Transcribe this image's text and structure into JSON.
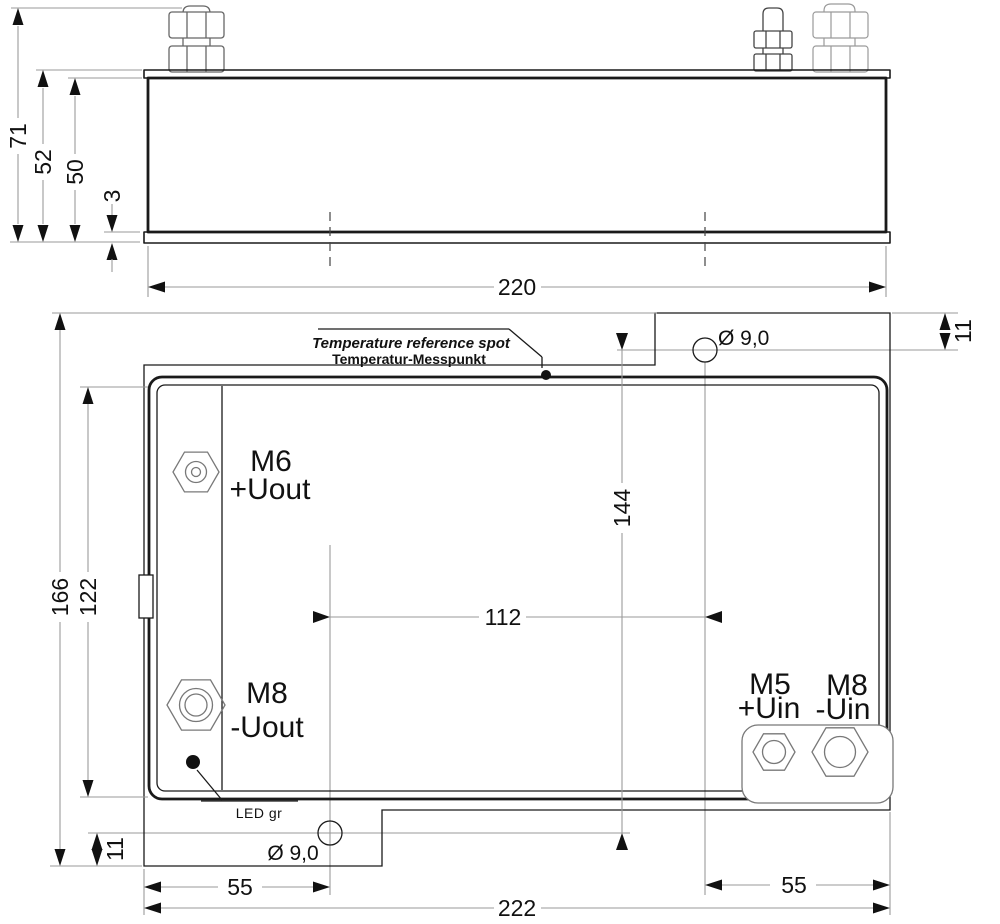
{
  "colors": {
    "object_line": "#1a1a1a",
    "dimension_line": "#9a9a9a",
    "detail_line": "#787878",
    "background": "#ffffff"
  },
  "side_view": {
    "dims": {
      "overall_height": "71",
      "flange_height": "52",
      "body_height": "50",
      "base_thickness": "3",
      "body_width": "220"
    }
  },
  "plan_view": {
    "callout": {
      "line1": "Temperature reference spot",
      "line2": "Temperatur-Messpunkt"
    },
    "holes": {
      "top_label": "Ø 9,0",
      "bottom_label": "Ø 9,0"
    },
    "dims": {
      "tab_offset_top": "11",
      "tab_offset_bottom": "11",
      "hole_span_vertical": "144",
      "hole_span_horizontal": "112",
      "overall_height": "166",
      "body_height": "122",
      "hole_left_offset": "55",
      "hole_right_offset": "55",
      "overall_width": "222"
    },
    "led_label": "LED gr",
    "terminals": [
      {
        "thread": "M6",
        "signal": "+Uout"
      },
      {
        "thread": "M8",
        "signal": "-Uout"
      },
      {
        "thread": "M5",
        "signal": "+Uin"
      },
      {
        "thread": "M8",
        "signal": "-Uin"
      }
    ]
  }
}
